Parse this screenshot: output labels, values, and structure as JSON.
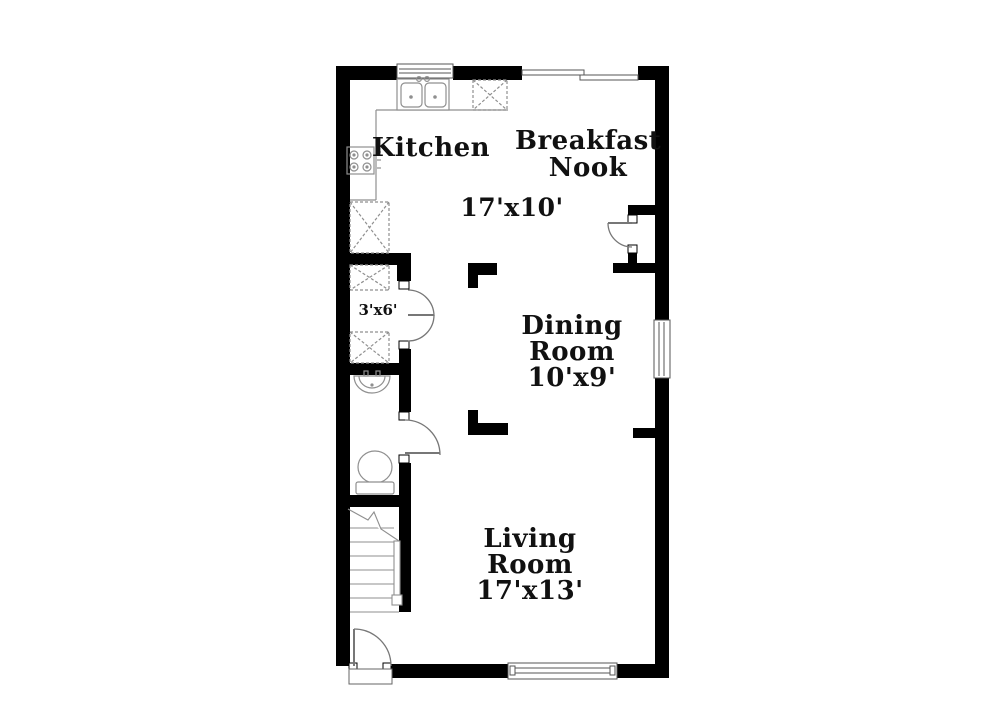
{
  "plan": {
    "type": "floor-plan",
    "rooms": {
      "kitchen": {
        "name": "Kitchen"
      },
      "breakfast_nook": {
        "name_line1": "Breakfast",
        "name_line2": "Nook"
      },
      "kitchen_nook_dimensions": "17'x10'",
      "dining_room": {
        "name_line1": "Dining",
        "name_line2": "Room",
        "dimensions": "10'x9'"
      },
      "living_room": {
        "name_line1": "Living",
        "name_line2": "Room",
        "dimensions": "17'x13'"
      },
      "closet": {
        "dimensions": "3'x6'"
      }
    },
    "fixtures": [
      "double-basin-sink-icon",
      "dishwasher-icon",
      "range-stove-icon",
      "pantry-cabinet-icon",
      "closet-shelves-icon",
      "bathroom-sink-icon",
      "toilet-icon",
      "staircase-icon",
      "window-icon",
      "sliding-glass-door-icon",
      "swing-door-icon"
    ],
    "colors": {
      "wall": "#000000",
      "background": "#ffffff",
      "fixture_line": "#8f8f8f",
      "door_line": "#777777",
      "text": "#111111"
    }
  }
}
